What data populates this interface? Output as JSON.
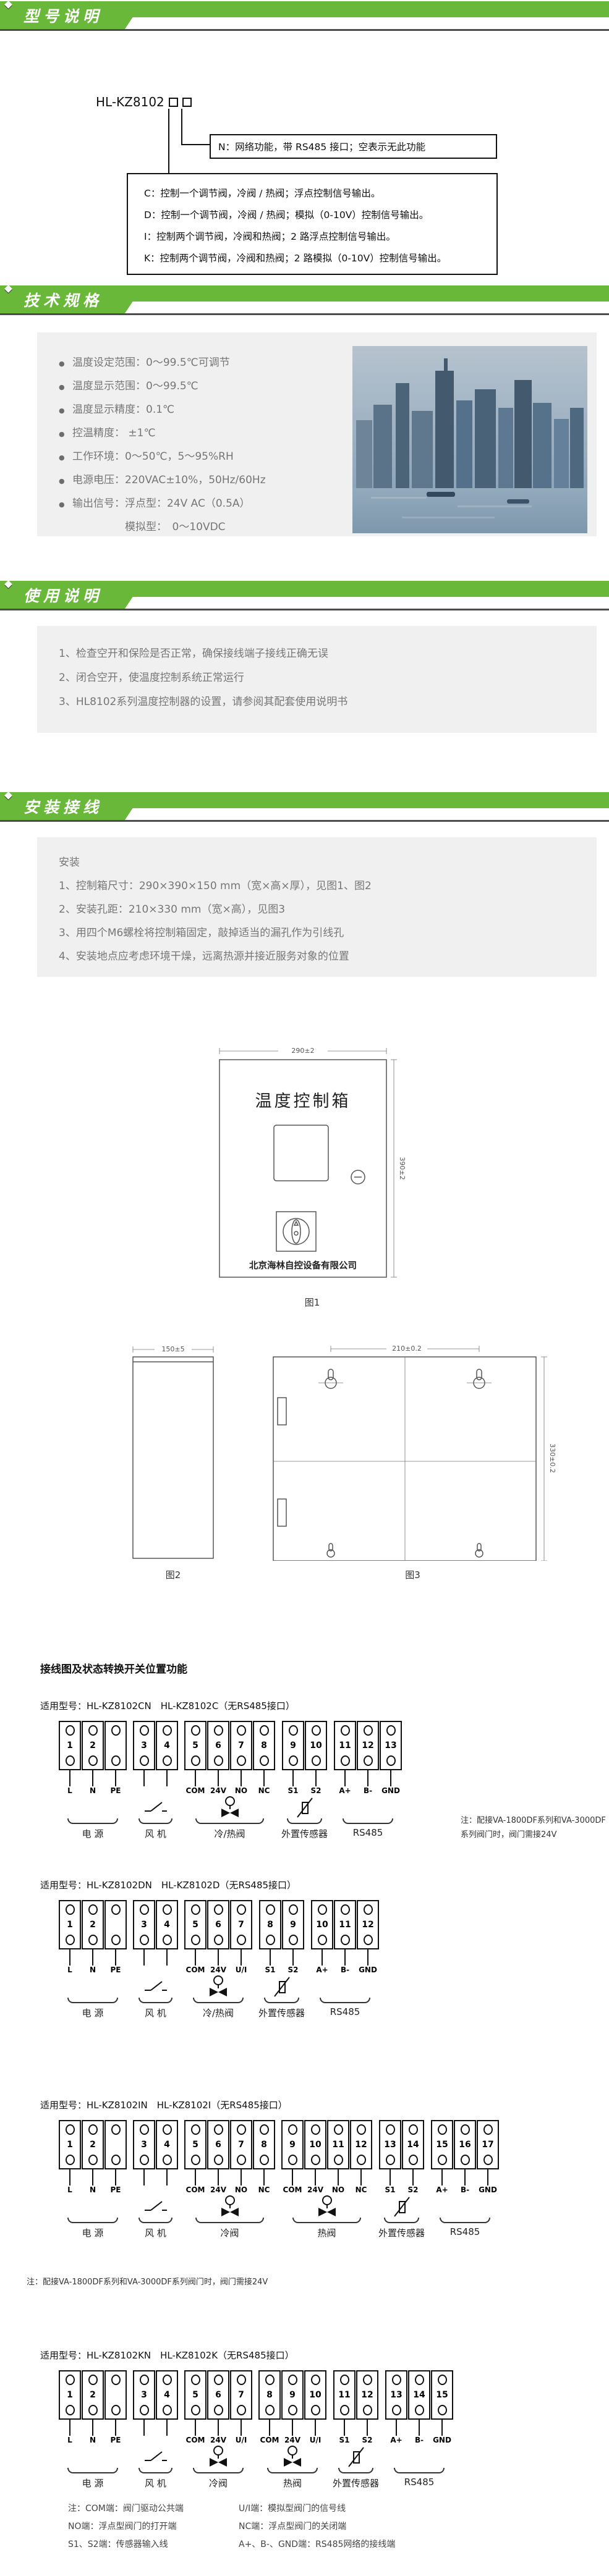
{
  "colors": {
    "green": "#6ab83a",
    "panel_gray": "#f0f0f0",
    "shadow_gray": "#4c4c4c"
  },
  "headers": {
    "model": "型号说明",
    "specs": "技术规格",
    "usage": "使用说明",
    "install": "安装接线"
  },
  "model": {
    "code": "HL-KZ8102",
    "n_box": "N：网络功能，带 RS485 接口；空表示无此功能",
    "option_lines": [
      "C：控制一个调节阀，冷阀 / 热阀；浮点控制信号输出。",
      "D：控制一个调节阀，冷阀 / 热阀；模拟（0-10V）控制信号输出。",
      "I：控制两个调节阀，冷阀和热阀；2 路浮点控制信号输出。",
      "K：控制两个调节阀，冷阀和热阀；2 路模拟（0-10V）控制信号输出。"
    ]
  },
  "specs": {
    "items": [
      {
        "b": "●",
        "text": "温度设定范围：0～99.5℃可调节"
      },
      {
        "b": "●",
        "text": "温度显示范围：0～99.5℃"
      },
      {
        "b": "●",
        "text": "温度显示精度：0.1℃"
      },
      {
        "b": "●",
        "text": "控温精度： ±1℃"
      },
      {
        "b": "●",
        "text": "工作环境：0～50℃，5～95%RH"
      },
      {
        "b": "●",
        "text": "电源电压：220VAC±10%，50Hz/60Hz"
      },
      {
        "b": "●",
        "text": "输出信号：浮点型：24V AC（0.5A）"
      },
      {
        "b": "",
        "text": "　　　　　模拟型：　0～10VDC"
      }
    ]
  },
  "usage": {
    "items": [
      "1、检查空开和保险是否正常，确保接线端子接线正确无误",
      "2、闭合空开，使温度控制系统正常运行",
      "3、HL8102系列温度控制器的设置，请参阅其配套使用说明书"
    ]
  },
  "install": {
    "subtitle": "安装",
    "items": [
      "1、控制箱尺寸：290×390×150 mm（宽×高×厚），见图1、图2",
      "2、安装孔距：210×330 mm（宽×高），见图3",
      "3、用四个M6螺栓将控制箱固定，敲掉适当的漏孔作为引线孔",
      "4、安装地点应考虑环境干燥，远离热源并接近服务对象的位置"
    ]
  },
  "figures": {
    "fig1": {
      "dim_w": "290±2",
      "dim_h": "390±2",
      "panel_title": "温度控制箱",
      "company": "北京海林自控设备有限公司",
      "caption": "图1"
    },
    "fig2": {
      "dim_w": "150±5",
      "caption": "图2"
    },
    "fig3": {
      "dim_w": "210±0.2",
      "dim_h": "330±0.2",
      "caption": "图3"
    }
  },
  "wiring": {
    "title": "接线图及状态转换开关位置功能",
    "diagrams": [
      {
        "model_line": "适用型号：HL-KZ8102CN　HL-KZ8102C（无RS485接口）",
        "note": "注：配接VA-1800DF系列和VA-3000DF\n系列阀门时，阀门需接24V",
        "groups": [
          {
            "name": "电  源",
            "symbol": "none",
            "terminals": [
              {
                "n": "1",
                "label": "L"
              },
              {
                "n": "2",
                "label": "N"
              },
              {
                "n": "",
                "label": "PE"
              }
            ]
          },
          {
            "name": "风  机",
            "symbol": "switch",
            "terminals": [
              {
                "n": "3",
                "label": ""
              },
              {
                "n": "4",
                "label": ""
              }
            ]
          },
          {
            "name": "冷/热阀",
            "symbol": "valve",
            "terminals": [
              {
                "n": "5",
                "label": "COM"
              },
              {
                "n": "6",
                "label": "24V"
              },
              {
                "n": "7",
                "label": "NO"
              },
              {
                "n": "8",
                "label": "NC"
              }
            ]
          },
          {
            "name": "外置传感器",
            "symbol": "sensor",
            "terminals": [
              {
                "n": "9",
                "label": "S1"
              },
              {
                "n": "10",
                "label": "S2"
              }
            ]
          },
          {
            "name": "RS485",
            "symbol": "none",
            "terminals": [
              {
                "n": "11",
                "label": "A+"
              },
              {
                "n": "12",
                "label": "B-"
              },
              {
                "n": "13",
                "label": "GND"
              }
            ]
          }
        ]
      },
      {
        "model_line": "适用型号：HL-KZ8102DN　HL-KZ8102D（无RS485接口）",
        "note": "",
        "groups": [
          {
            "name": "电  源",
            "symbol": "none",
            "terminals": [
              {
                "n": "1",
                "label": "L"
              },
              {
                "n": "2",
                "label": "N"
              },
              {
                "n": "",
                "label": "PE"
              }
            ]
          },
          {
            "name": "风  机",
            "symbol": "switch",
            "terminals": [
              {
                "n": "3",
                "label": ""
              },
              {
                "n": "4",
                "label": ""
              }
            ]
          },
          {
            "name": "冷/热阀",
            "symbol": "valve",
            "terminals": [
              {
                "n": "5",
                "label": "COM"
              },
              {
                "n": "6",
                "label": "24V"
              },
              {
                "n": "7",
                "label": "U/I"
              }
            ]
          },
          {
            "name": "外置传感器",
            "symbol": "sensor",
            "terminals": [
              {
                "n": "8",
                "label": "S1"
              },
              {
                "n": "9",
                "label": "S2"
              }
            ]
          },
          {
            "name": "RS485",
            "symbol": "none",
            "terminals": [
              {
                "n": "10",
                "label": "A+"
              },
              {
                "n": "11",
                "label": "B-"
              },
              {
                "n": "12",
                "label": "GND"
              }
            ]
          }
        ]
      },
      {
        "model_line": "适用型号：HL-KZ8102IN　HL-KZ8102I（无RS485接口）",
        "note": "注：配接VA-1800DF系列和VA-3000DF系列阀门时，阀门需接24V",
        "groups": [
          {
            "name": "电  源",
            "symbol": "none",
            "terminals": [
              {
                "n": "1",
                "label": "L"
              },
              {
                "n": "2",
                "label": "N"
              },
              {
                "n": "",
                "label": "PE"
              }
            ]
          },
          {
            "name": "风  机",
            "symbol": "switch",
            "terminals": [
              {
                "n": "3",
                "label": ""
              },
              {
                "n": "4",
                "label": ""
              }
            ]
          },
          {
            "name": "冷阀",
            "symbol": "valve",
            "terminals": [
              {
                "n": "5",
                "label": "COM"
              },
              {
                "n": "6",
                "label": "24V"
              },
              {
                "n": "7",
                "label": "NO"
              },
              {
                "n": "8",
                "label": "NC"
              }
            ]
          },
          {
            "name": "热阀",
            "symbol": "valve",
            "terminals": [
              {
                "n": "9",
                "label": "COM"
              },
              {
                "n": "10",
                "label": "24V"
              },
              {
                "n": "11",
                "label": "NO"
              },
              {
                "n": "12",
                "label": "NC"
              }
            ]
          },
          {
            "name": "外置传感器",
            "symbol": "sensor",
            "terminals": [
              {
                "n": "13",
                "label": "S1"
              },
              {
                "n": "14",
                "label": "S2"
              }
            ]
          },
          {
            "name": "RS485",
            "symbol": "none",
            "terminals": [
              {
                "n": "15",
                "label": "A+"
              },
              {
                "n": "16",
                "label": "B-"
              },
              {
                "n": "17",
                "label": "GND"
              }
            ]
          }
        ]
      },
      {
        "model_line": "适用型号：HL-KZ8102KN　HL-KZ8102K（无RS485接口）",
        "note": "",
        "groups": [
          {
            "name": "电  源",
            "symbol": "none",
            "terminals": [
              {
                "n": "1",
                "label": "L"
              },
              {
                "n": "2",
                "label": "N"
              },
              {
                "n": "",
                "label": "PE"
              }
            ]
          },
          {
            "name": "风  机",
            "symbol": "switch",
            "terminals": [
              {
                "n": "3",
                "label": ""
              },
              {
                "n": "4",
                "label": ""
              }
            ]
          },
          {
            "name": "冷阀",
            "symbol": "valve",
            "terminals": [
              {
                "n": "5",
                "label": "COM"
              },
              {
                "n": "6",
                "label": "24V"
              },
              {
                "n": "7",
                "label": "U/I"
              }
            ]
          },
          {
            "name": "热阀",
            "symbol": "valve",
            "terminals": [
              {
                "n": "8",
                "label": "COM"
              },
              {
                "n": "9",
                "label": "24V"
              },
              {
                "n": "10",
                "label": "U/I"
              }
            ]
          },
          {
            "name": "外置传感器",
            "symbol": "sensor",
            "terminals": [
              {
                "n": "11",
                "label": "S1"
              },
              {
                "n": "12",
                "label": "S2"
              }
            ]
          },
          {
            "name": "RS485",
            "symbol": "none",
            "terminals": [
              {
                "n": "13",
                "label": "A+"
              },
              {
                "n": "14",
                "label": "B-"
              },
              {
                "n": "15",
                "label": "GND"
              }
            ]
          }
        ]
      }
    ],
    "footnotes": [
      [
        "注：COM端：阀门驱动公共端",
        "U/I端：模拟型阀门的信号线"
      ],
      [
        "NO端：浮点型阀门的打开端",
        "NC端：浮点型阀门的关闭端"
      ],
      [
        "S1、S2端：传感器输入线",
        "A+、B-、GND端：RS485网络的接线端"
      ]
    ]
  }
}
